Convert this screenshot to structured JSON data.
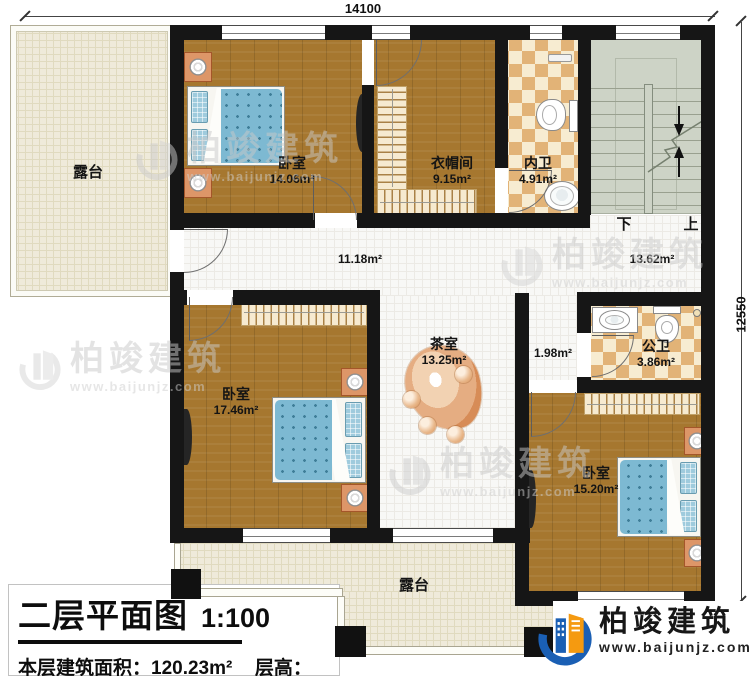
{
  "dimensions": {
    "top": "14100",
    "right": "12550"
  },
  "rooms": {
    "terrace_top": {
      "name": "露台"
    },
    "bedroom_top": {
      "name": "卧室",
      "area": "14.06m²"
    },
    "cloakroom": {
      "name": "衣帽间",
      "area": "9.15m²"
    },
    "bath_inner": {
      "name": "内卫",
      "area": "4.91m²"
    },
    "hallway": {
      "area": "11.18m²"
    },
    "stair_hall": {
      "area": "13.62m²"
    },
    "tea_room": {
      "name": "茶室",
      "area": "13.25m²"
    },
    "corridor": {
      "area": "1.98m²"
    },
    "bath_public": {
      "name": "公卫",
      "area": "3.86m²"
    },
    "bedroom_left": {
      "name": "卧室",
      "area": "17.46m²"
    },
    "bedroom_right": {
      "name": "卧室",
      "area": "15.20m²"
    },
    "terrace_bottom": {
      "name": "露台"
    }
  },
  "stairs": {
    "down": "下",
    "up": "上"
  },
  "title_block": {
    "title": "二层平面图",
    "scale": "1:100",
    "area_label": "本层建筑面积：",
    "area_value": "120.23m²",
    "height_label": "层高：",
    "height_value": "3.3m"
  },
  "brand": {
    "name": "柏竣建筑",
    "website": "www.baijunjz.com"
  },
  "watermark": {
    "name": "柏竣建筑",
    "website": "www.baijunjz.com"
  },
  "colors": {
    "wall": "#161616",
    "wood": "#a6772f",
    "tile": "#f8f8f6",
    "terrace": "#efeada",
    "checker": "#e2b377",
    "stairs": "#cdd3c6",
    "bed_blue": "#7db9d2",
    "nightstand": "#dd9668",
    "logo_blue": "#1a5fb4",
    "logo_orange": "#f59a10"
  }
}
